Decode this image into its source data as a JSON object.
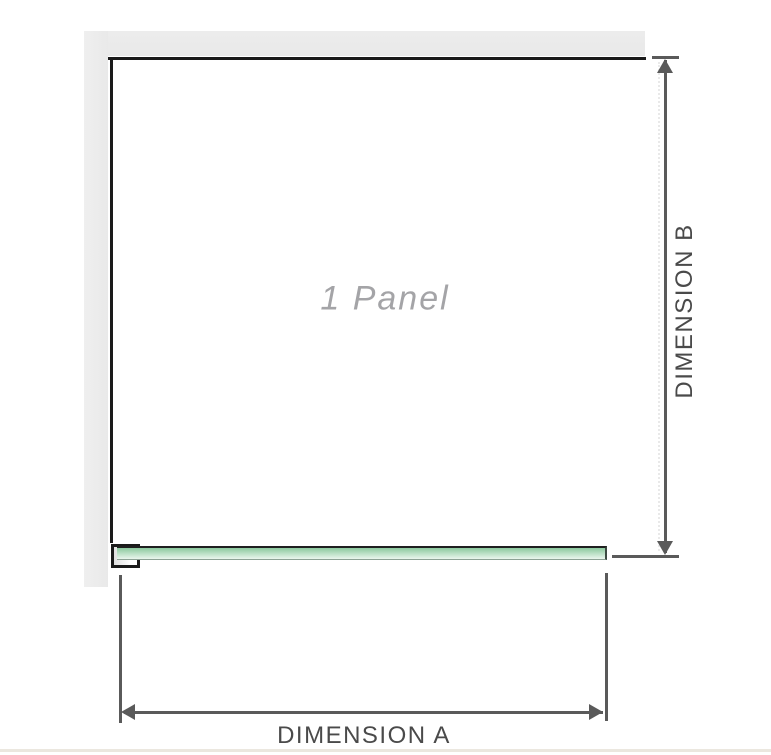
{
  "diagram": {
    "panel_label": "1 Panel",
    "dimension_vertical": {
      "label": "DIMENSION B"
    },
    "dimension_horizontal": {
      "label": "DIMENSION A"
    }
  },
  "colors": {
    "wall": "#e9e9e9",
    "outline": "#1a1a1a",
    "glass-top": "#8bc99e",
    "glass-bottom": "#eaf6ee",
    "glass-edge": "#8da295",
    "dim-line": "#5a5a5a",
    "dim-text": "#4a4a4a",
    "panel-text": "#a4a4a7",
    "baseline": "#ebe7df",
    "faint-dash": "#e9e9e9"
  }
}
